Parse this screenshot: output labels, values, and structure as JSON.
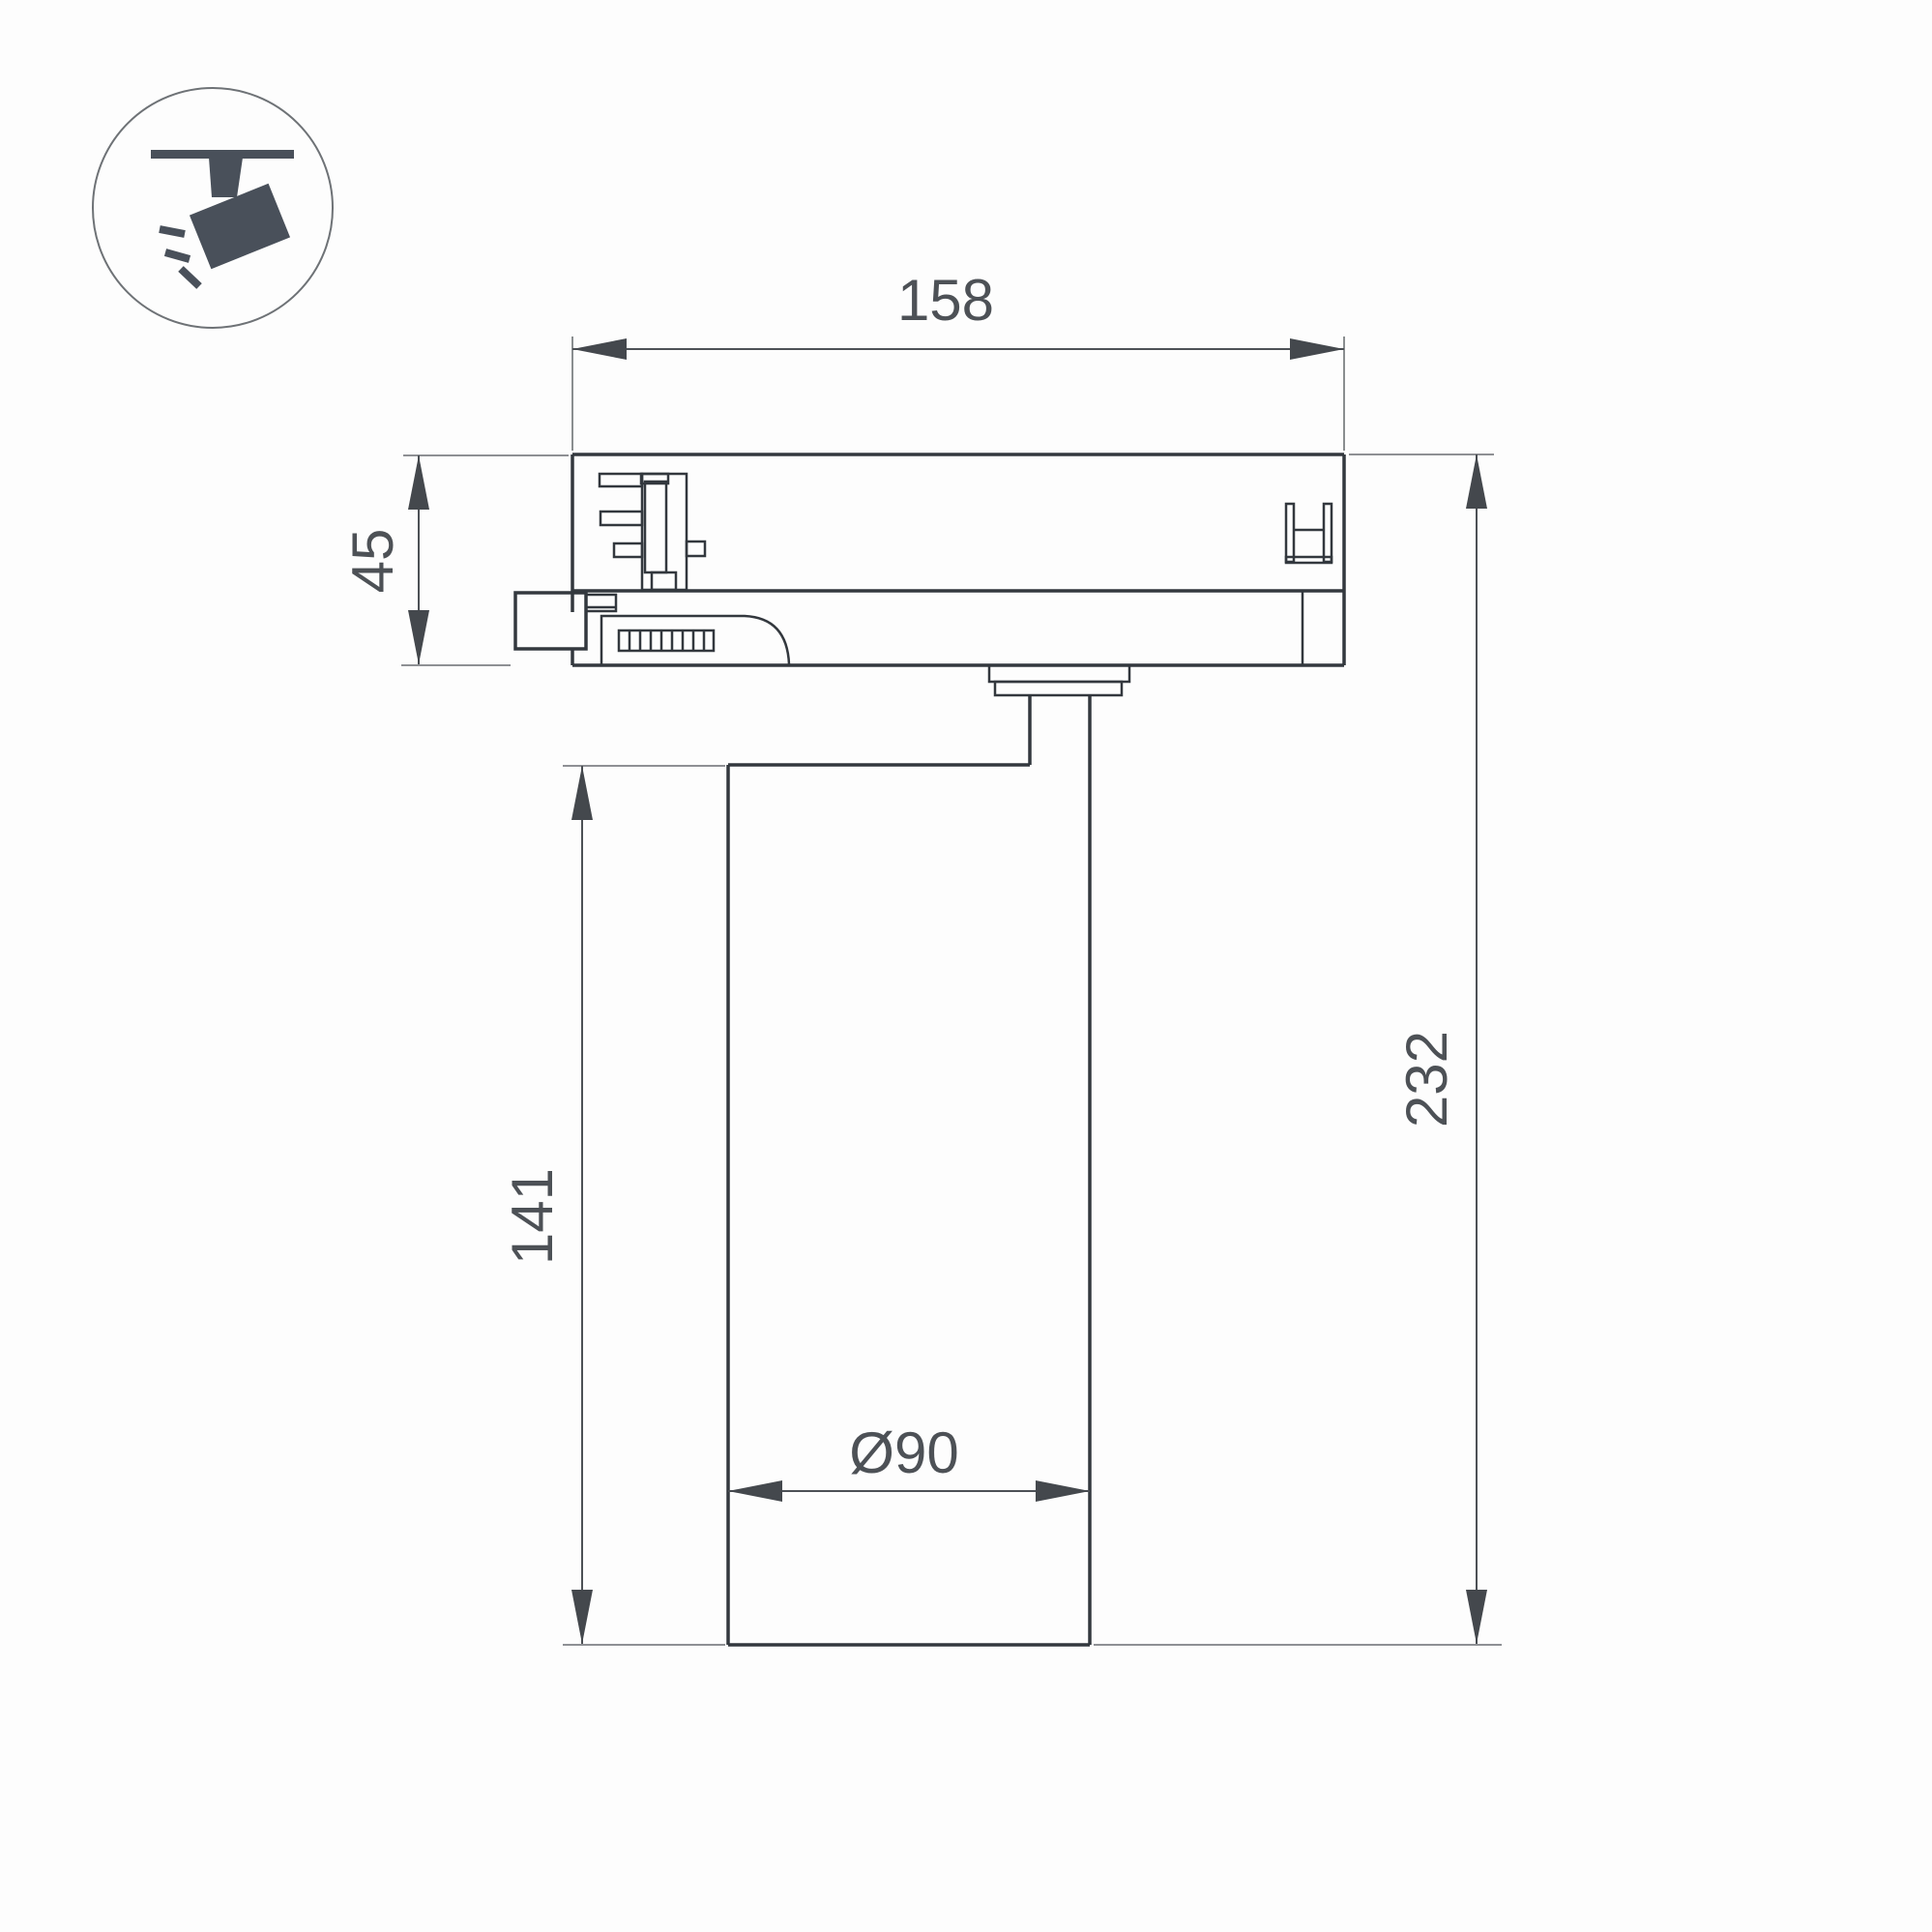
{
  "drawing": {
    "type": "technical-dimension-drawing",
    "subject": "track-mounted spotlight luminaire, side section view",
    "units_shown": "mm",
    "colors": {
      "background": "#fdfdfd",
      "part_outline": "#33383e",
      "dimension_line": "#4d5156",
      "extension_line": "#7e8184",
      "text": "#4d5156",
      "icon": "#49505a"
    },
    "icon": {
      "name": "track-spotlight-pictogram",
      "description": "circle badge with ceiling track and tilted spotlight emitting rays"
    },
    "dimensions": {
      "track_adapter_width": "158",
      "track_adapter_height": "45",
      "body_height": "141",
      "total_height": "232",
      "body_diameter": "Ø90"
    }
  }
}
